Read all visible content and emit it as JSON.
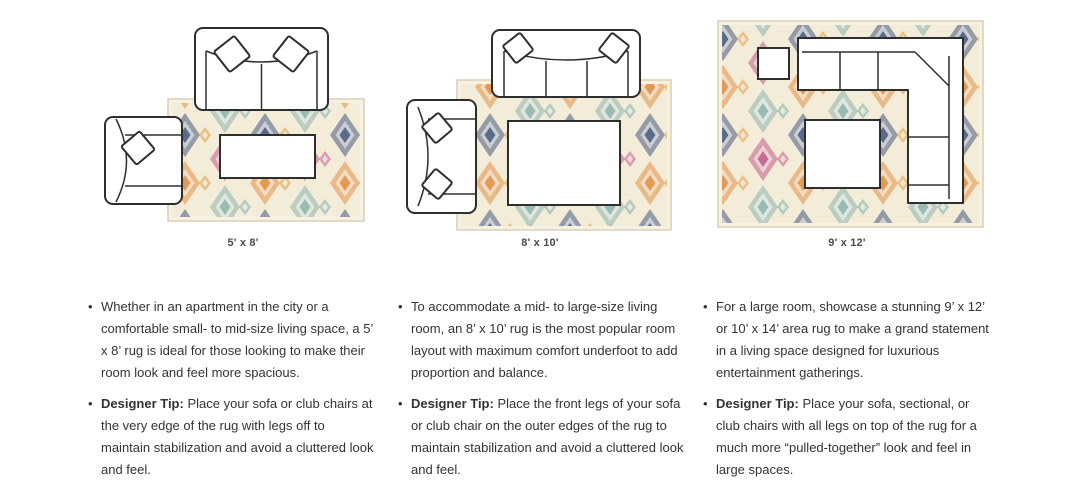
{
  "guide": {
    "columns": [
      {
        "caption": "5' x 8'",
        "bullet": "Whether in an apartment in the city or a comfortable small- to mid-size living space, a 5’ x 8’ rug is ideal for those looking to make their room look and feel more spacious.",
        "tip_label": "Designer Tip:",
        "tip": "Place your sofa or club chairs at the very edge of the rug with legs off to maintain stabilization and avoid a cluttered look and feel."
      },
      {
        "caption": "8' x 10'",
        "bullet": "To accommodate a mid- to large-size living room, an 8’ x 10’ rug is the most popular room layout with maximum comfort underfoot to add proportion and balance.",
        "tip_label": "Designer Tip:",
        "tip": "Place the front legs of your sofa or club chair on the outer edges of the rug to maintain stabilization and avoid a cluttered look and feel."
      },
      {
        "caption": "9' x 12'",
        "bullet": "For a large room, showcase a stunning 9’ x 12’ or 10’ x 14’ area rug to make a grand statement in a living space designed for luxurious entertainment gatherings.",
        "tip_label": "Designer Tip:",
        "tip": "Place your sofa, sectional, or club chairs with all legs on top of the rug for a much more “pulled-together” look and feel in large spaces."
      }
    ],
    "rug_palette": {
      "background": "#f3ecd9",
      "navy": "#45597b",
      "orange": "#df8f44",
      "teal": "#8db4a9",
      "magenta": "#bd5c86",
      "gold": "#dfa64f"
    },
    "line_color": "#2e2e2e",
    "text_color": "#333333"
  }
}
